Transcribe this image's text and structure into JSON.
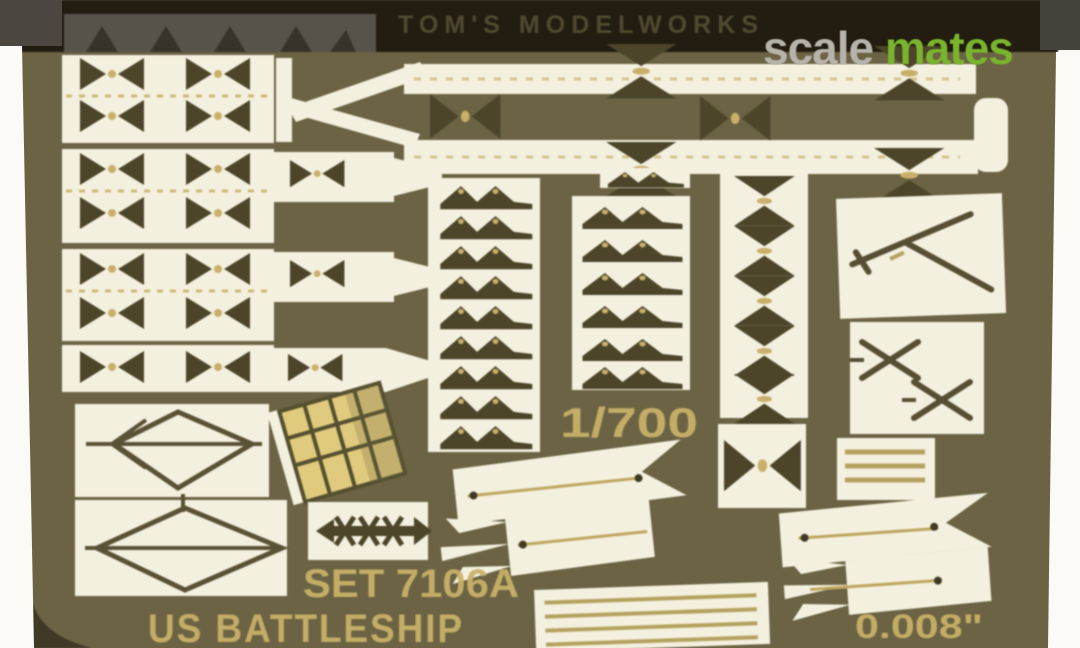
{
  "photo": {
    "brand_etched_text": "TOM'S MODELWORKS",
    "scale_etched_text": "1/700",
    "set_etched_text": "SET 7106A",
    "subject_etched_text": "US BATTLESHIP",
    "thickness_etched_text": "0.008\""
  },
  "watermark": {
    "prefix": "scale",
    "suffix": "mates",
    "prefix_color": "#b6b3ab",
    "suffix_color": "#7ab32d"
  },
  "colors": {
    "page_white": "#f8f7f2",
    "fret_brass": "#6b6344",
    "header_band": "#221c11",
    "part_cream": "#f4f0df",
    "etch_dark": "#4c452a",
    "gold_line": "#b5a260",
    "gold_text": "#c9b169",
    "radar_gold": "#e0ca7d",
    "band_glare_gray": "#57534b"
  }
}
